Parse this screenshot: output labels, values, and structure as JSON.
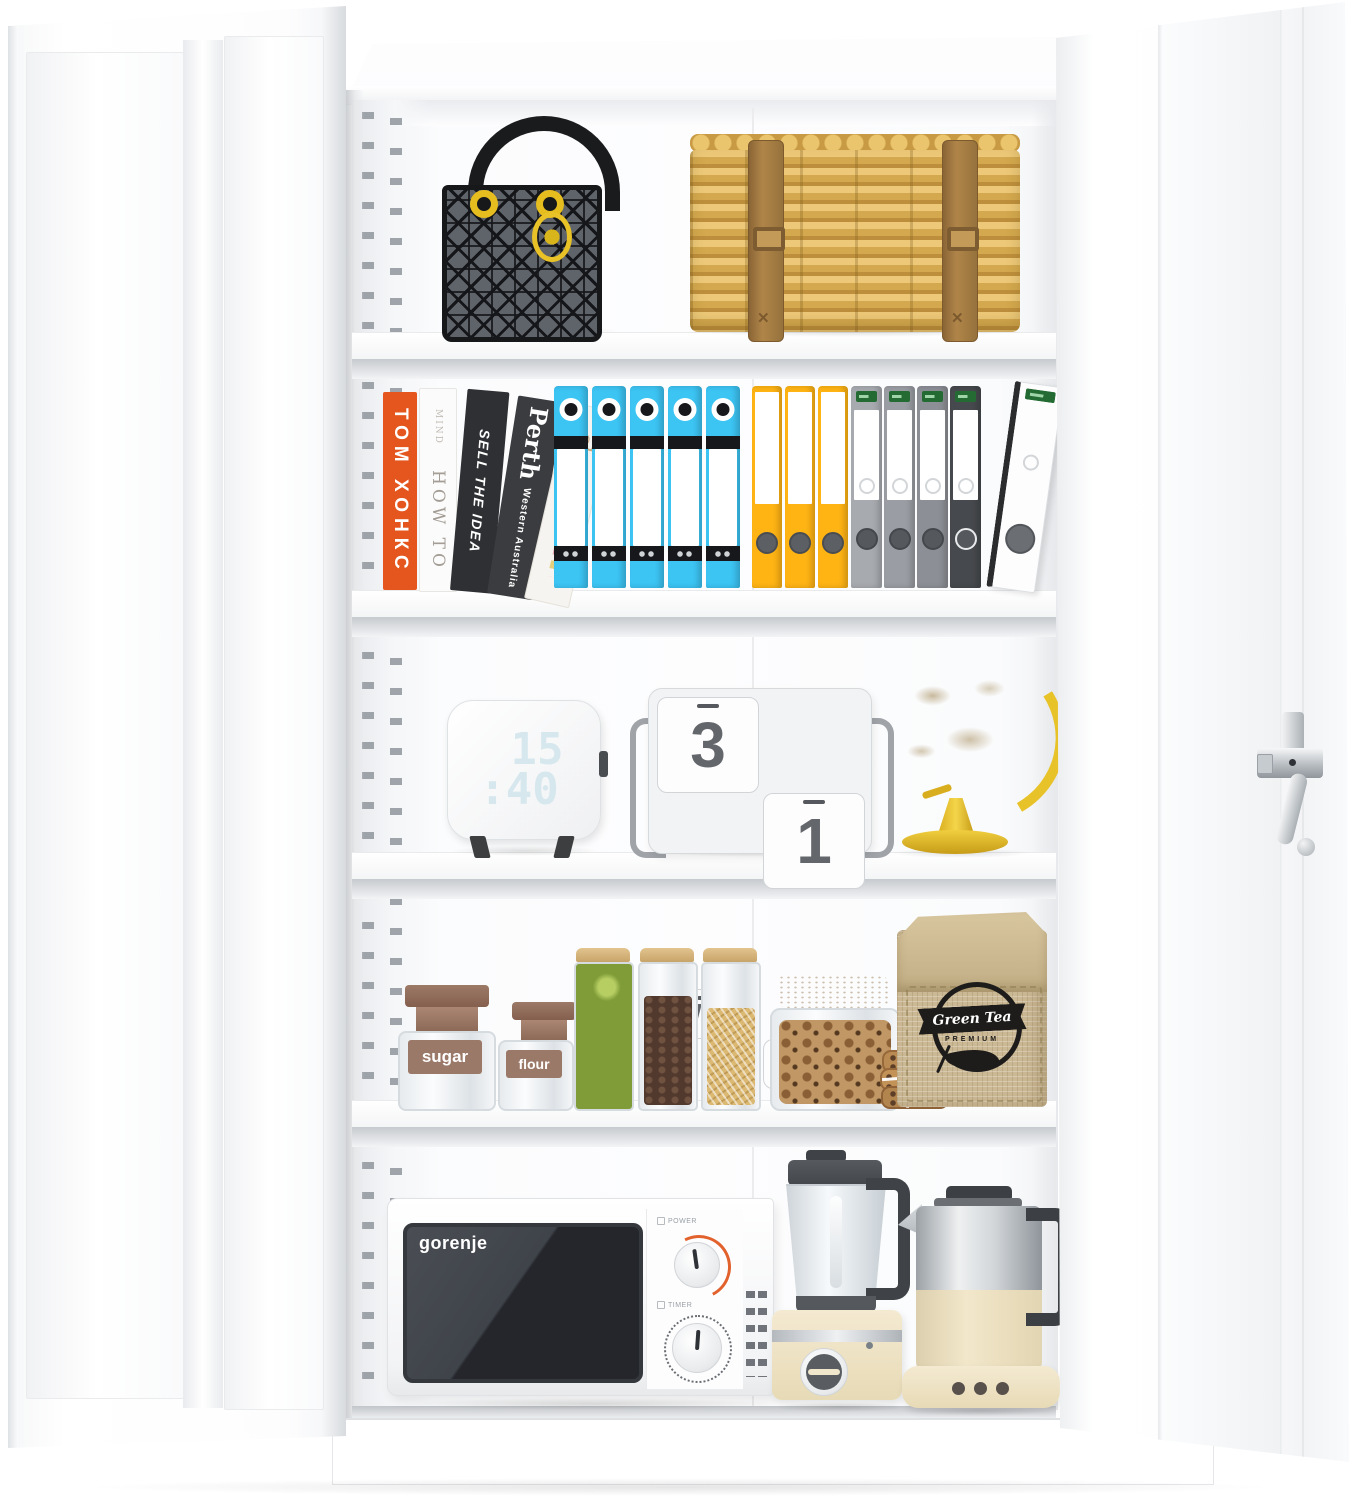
{
  "product": {
    "name": "white metal storage cabinet, doors open, five shelves filled with items"
  },
  "books": {
    "b1": "ТОМ ХОНКС",
    "b2_small": "MIND",
    "b2": "HOW TO",
    "b3": "SELL THE IDEA",
    "b4": "Perth",
    "b4_sub": "Western Australia",
    "b5": "clutter"
  },
  "binders": {
    "blue": {
      "count": 5,
      "color": "#3cc4f3"
    },
    "yellow": {
      "count": 3,
      "color": "#ffb414"
    },
    "gray": {
      "count": 4,
      "colors": [
        "#a7aaaf",
        "#9a9da3",
        "#8c8f95",
        "#46494d"
      ]
    },
    "white_leaning_count": 1
  },
  "clock": {
    "hours": "15",
    "minutes": ":40"
  },
  "calendar": {
    "digit_left": "3",
    "digit_right": "1",
    "weekday": "WED",
    "month_roman": "VI",
    "month_name": "JUNE"
  },
  "pantry": {
    "jar_sugar": "sugar",
    "jar_flour": "flour",
    "bag_brand": "Green Tea",
    "bag_grade": "PREMIUM"
  },
  "appliances": {
    "microwave_brand": "gorenje",
    "microwave_power_label": "POWER",
    "microwave_timer_label": "TIMER"
  },
  "palette": {
    "cabinet_white": "#ffffff",
    "binder_blue": "#3cc4f3",
    "binder_yellow": "#ffb414",
    "book_orange": "#e4561e",
    "basket_tan": "#d9ab55",
    "gold_hardware": "#e6bd1f",
    "burlap": "#cbb894",
    "appliance_cream": "#f0e6cb",
    "logo_black": "#1d1c1a",
    "knob_accent_orange": "#e2622e"
  }
}
